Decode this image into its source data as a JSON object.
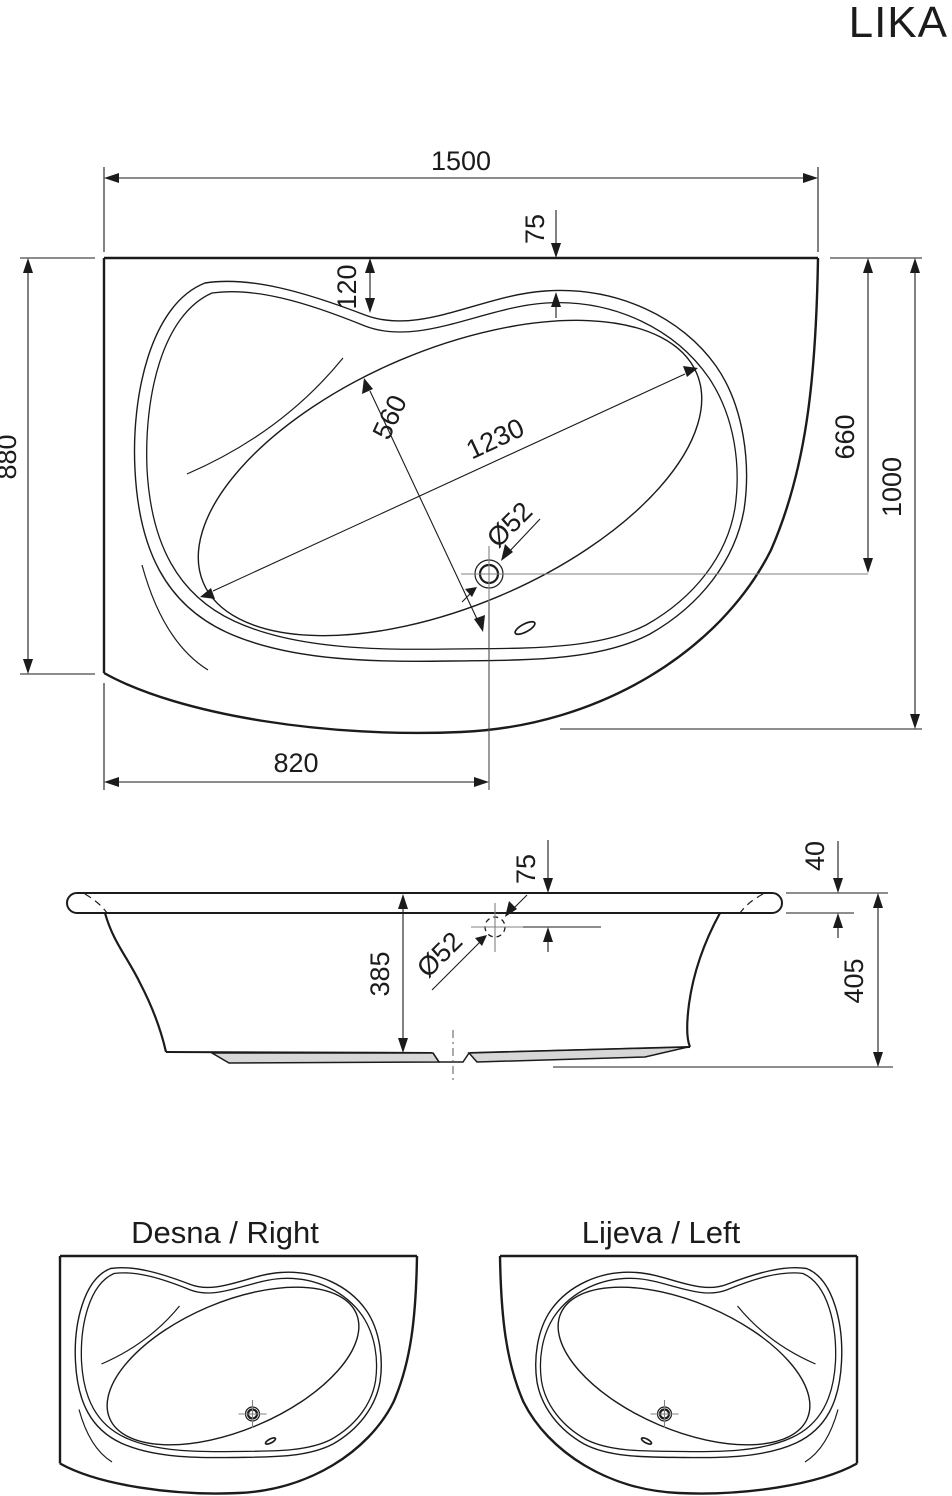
{
  "title": "LIKA",
  "colors": {
    "line": "#1b1b1b",
    "dim_line": "#1b1b1b",
    "center_line": "#808080",
    "base_fill": "#d7d7d7",
    "background": "#ffffff"
  },
  "top_view": {
    "dims": {
      "overall_width": "1500",
      "left_depth": "880",
      "drain_from_wall": "660",
      "overall_depth": "1000",
      "drain_from_left": "820",
      "rim_width_left": "120",
      "rim_width_top": "75",
      "basin_minor": "560",
      "basin_major": "1230",
      "drain_diameter": "Ø52"
    }
  },
  "side_view": {
    "dims": {
      "overflow_from_rim": "75",
      "rim_thickness": "40",
      "inner_depth": "385",
      "overall_height": "405",
      "overflow_diameter": "Ø52"
    }
  },
  "variants": {
    "right_label": "Desna / Right",
    "left_label": "Lijeva / Left"
  }
}
